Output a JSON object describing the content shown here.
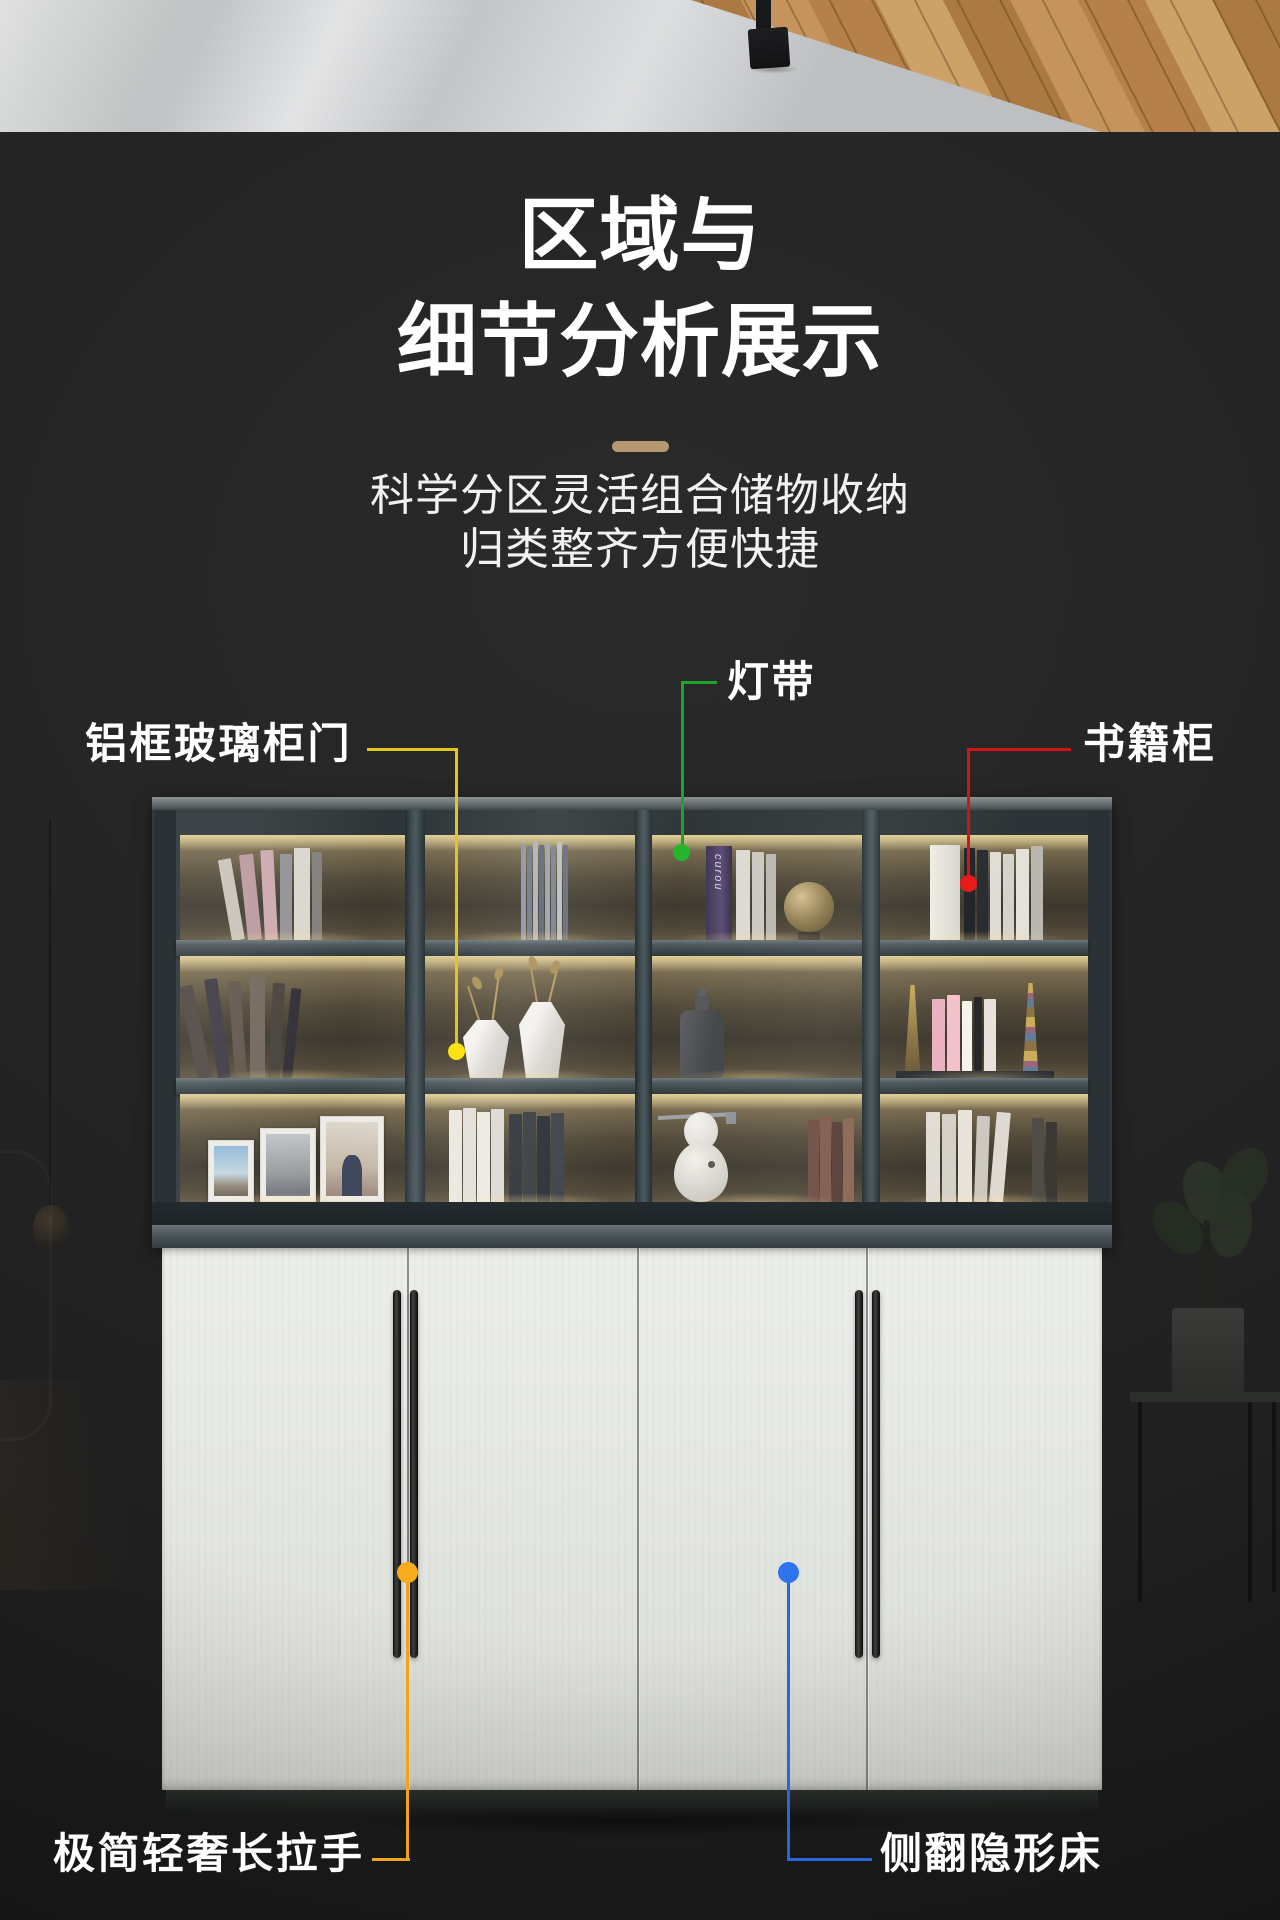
{
  "title": {
    "line1": "区域与",
    "line2": "细节分析展示"
  },
  "divider": {
    "color": "#b5986f"
  },
  "subtitle": {
    "line1": "科学分区灵活组合储物收纳",
    "line2": "归类整齐方便快捷"
  },
  "callouts": {
    "light_strip": {
      "label": "灯带",
      "color": "#1fa32c"
    },
    "glass_door": {
      "label": "铝框玻璃柜门",
      "color": "#e3c51e"
    },
    "book_cabinet": {
      "label": "书籍柜",
      "color": "#d21417"
    },
    "long_handle": {
      "label": "极简轻奢长拉手",
      "color": "#f0a31c"
    },
    "hidden_bed": {
      "label": "侧翻隐形床",
      "color": "#2767d9"
    }
  },
  "cabinet": {
    "book_spine_text": "curou"
  }
}
